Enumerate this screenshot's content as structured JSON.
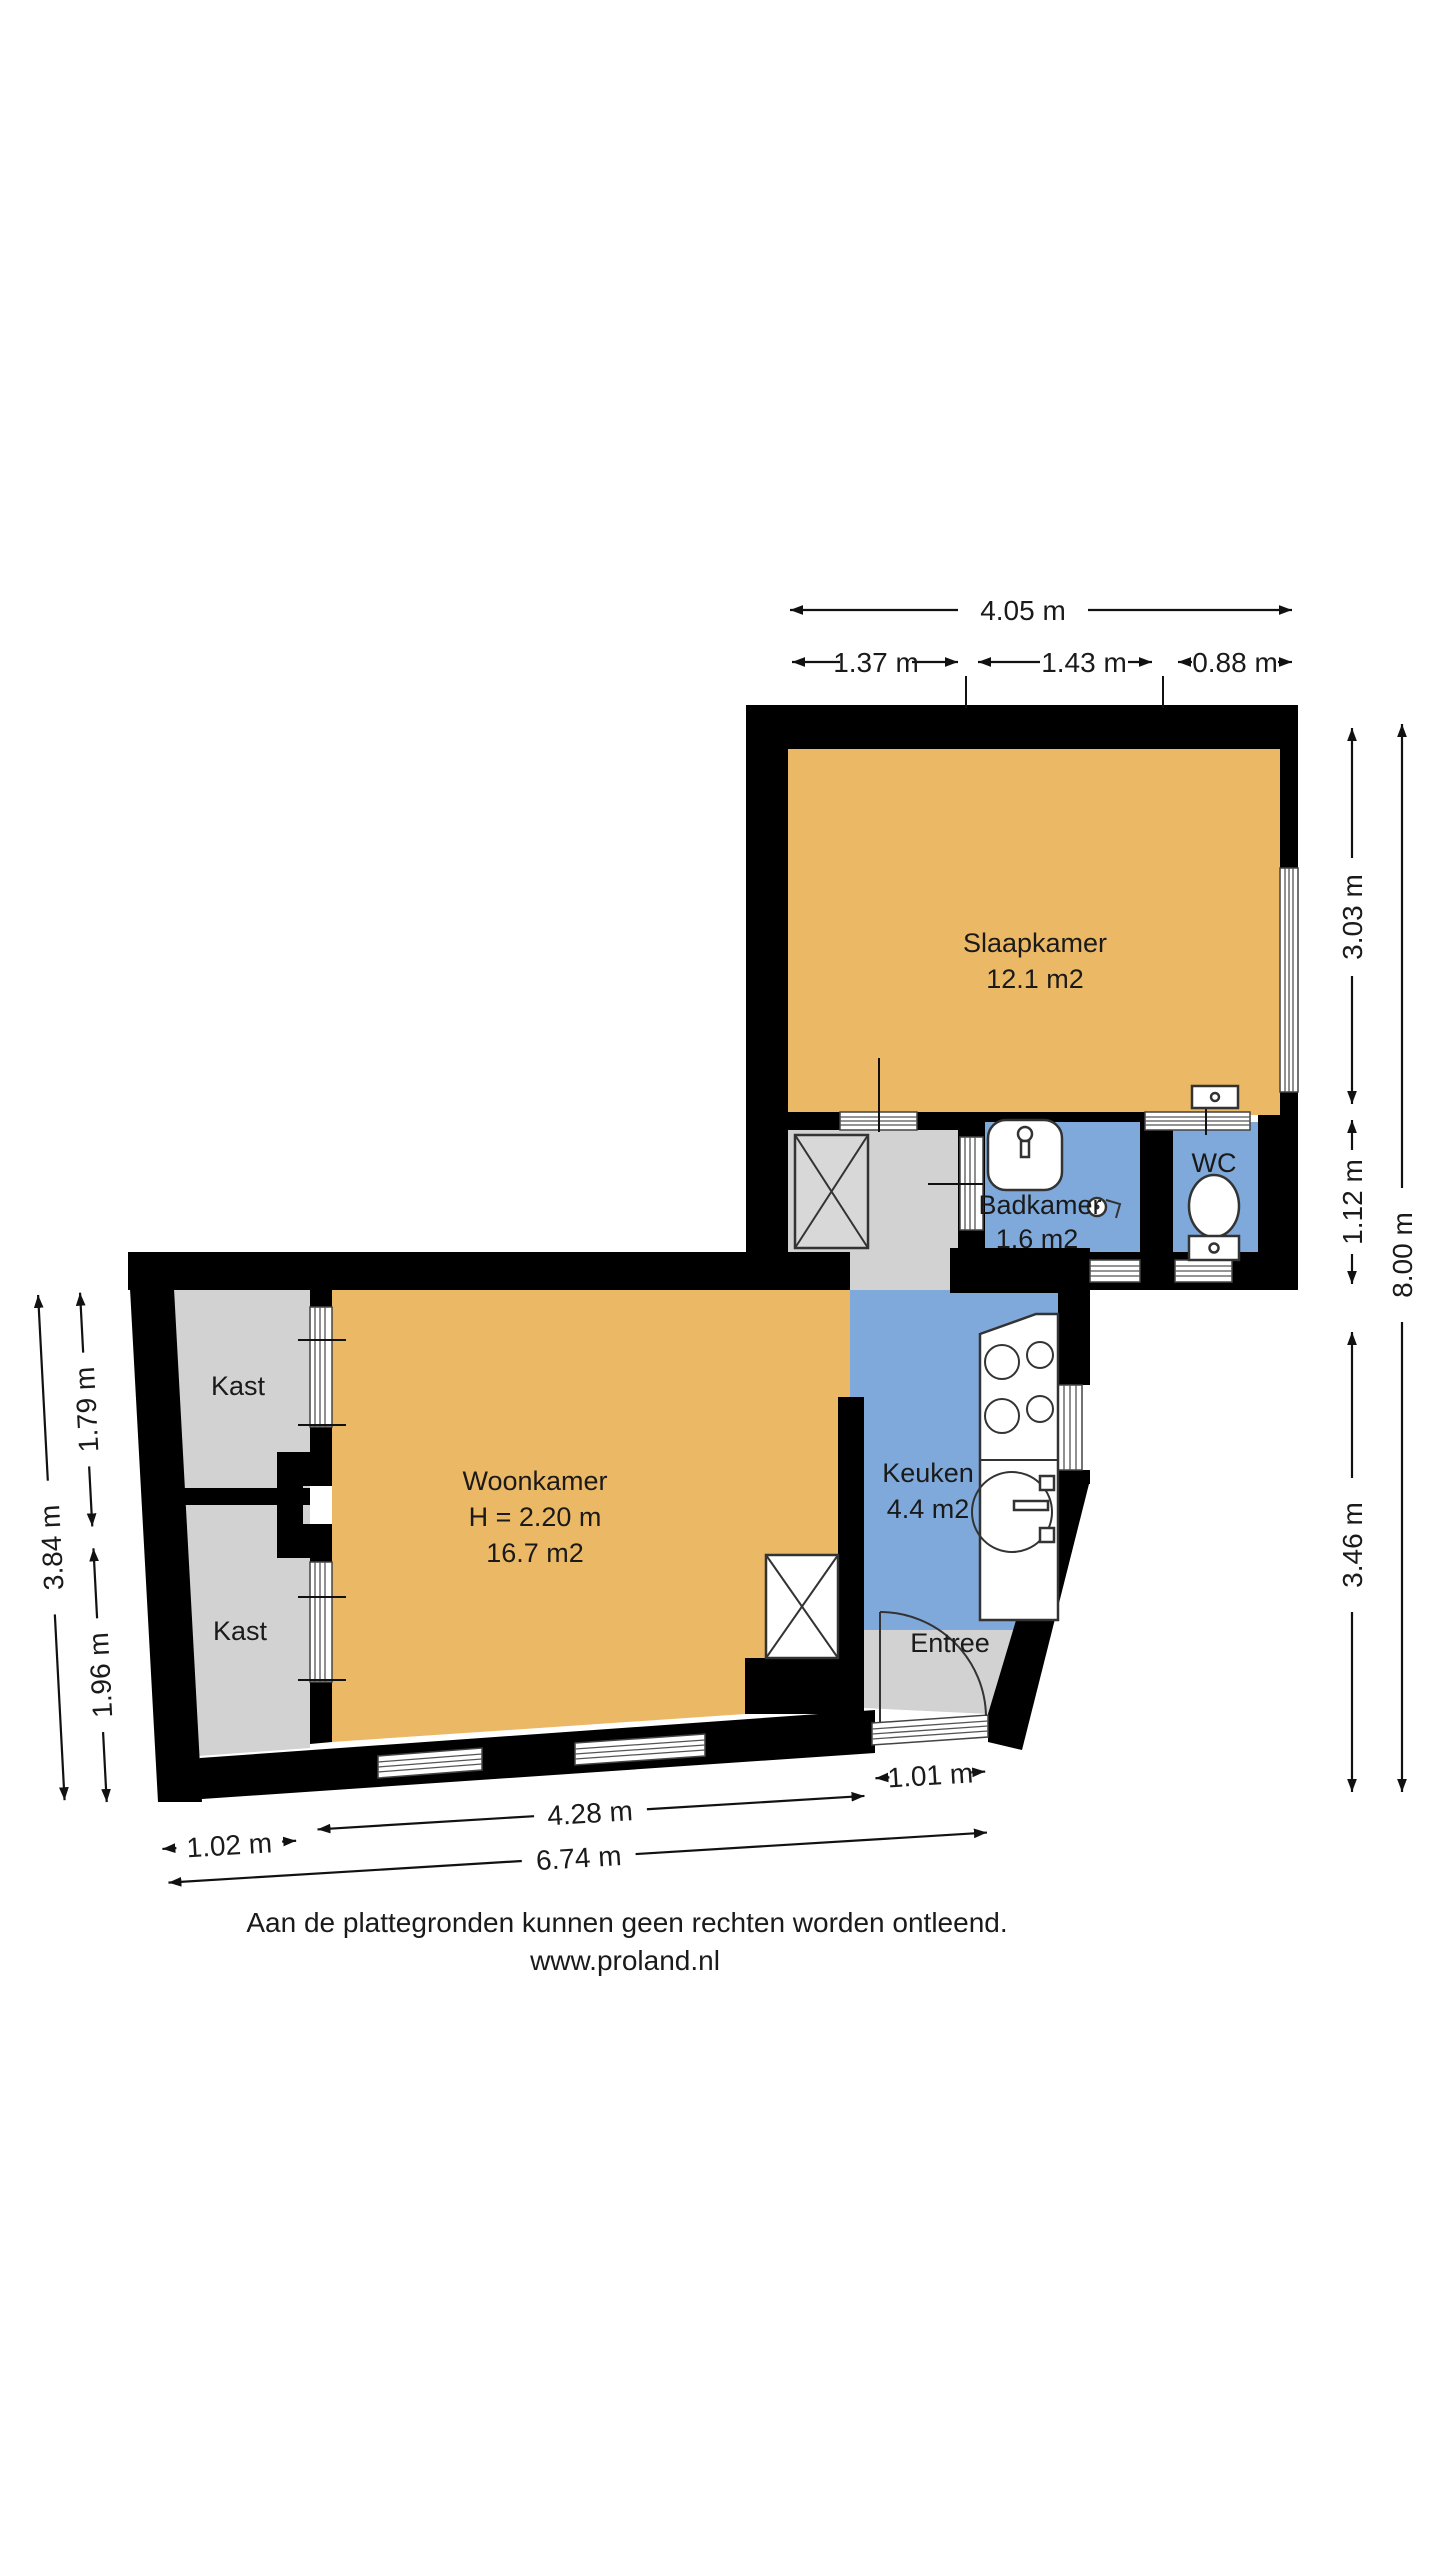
{
  "page": {
    "disclaimer": "Aan de plattegronden kunnen geen rechten worden ontleend.",
    "website": "www.proland.nl"
  },
  "rooms": {
    "slaapkamer": {
      "name": "Slaapkamer",
      "area": "12.1 m2"
    },
    "badkamer": {
      "name": "Badkamer",
      "area": "1.6 m2"
    },
    "wc": {
      "name": "WC"
    },
    "woonkamer": {
      "name": "Woonkamer",
      "height": "H = 2.20 m",
      "area": "16.7 m2"
    },
    "kast_boven": {
      "name": "Kast"
    },
    "kast_onder": {
      "name": "Kast"
    },
    "keuken": {
      "name": "Keuken",
      "area": "4.4 m2"
    },
    "entree": {
      "name": "Entree"
    }
  },
  "dimensions": {
    "top": {
      "total": "4.05 m",
      "segments": [
        "1.37 m",
        "1.43 m",
        "0.88 m"
      ]
    },
    "right": {
      "slaapkamer": "3.03 m",
      "badkamer_wc": "1.12 m",
      "woonkamer": "3.46 m",
      "totaal": "8.00 m"
    },
    "left": {
      "kast_boven": "1.79 m",
      "kast_onder": "1.96 m",
      "totaal": "3.84 m"
    },
    "bottom": {
      "kast": "1.02 m",
      "woonkamer": "4.28 m",
      "entree": "1.01 m",
      "totaal": "6.74 m"
    }
  },
  "colors": {
    "wall": "#000000",
    "room_floor": "#EBB866",
    "wet_room": "#7FA9DA",
    "circulation": "#D2D2D2",
    "text": "#1A1A1A"
  }
}
